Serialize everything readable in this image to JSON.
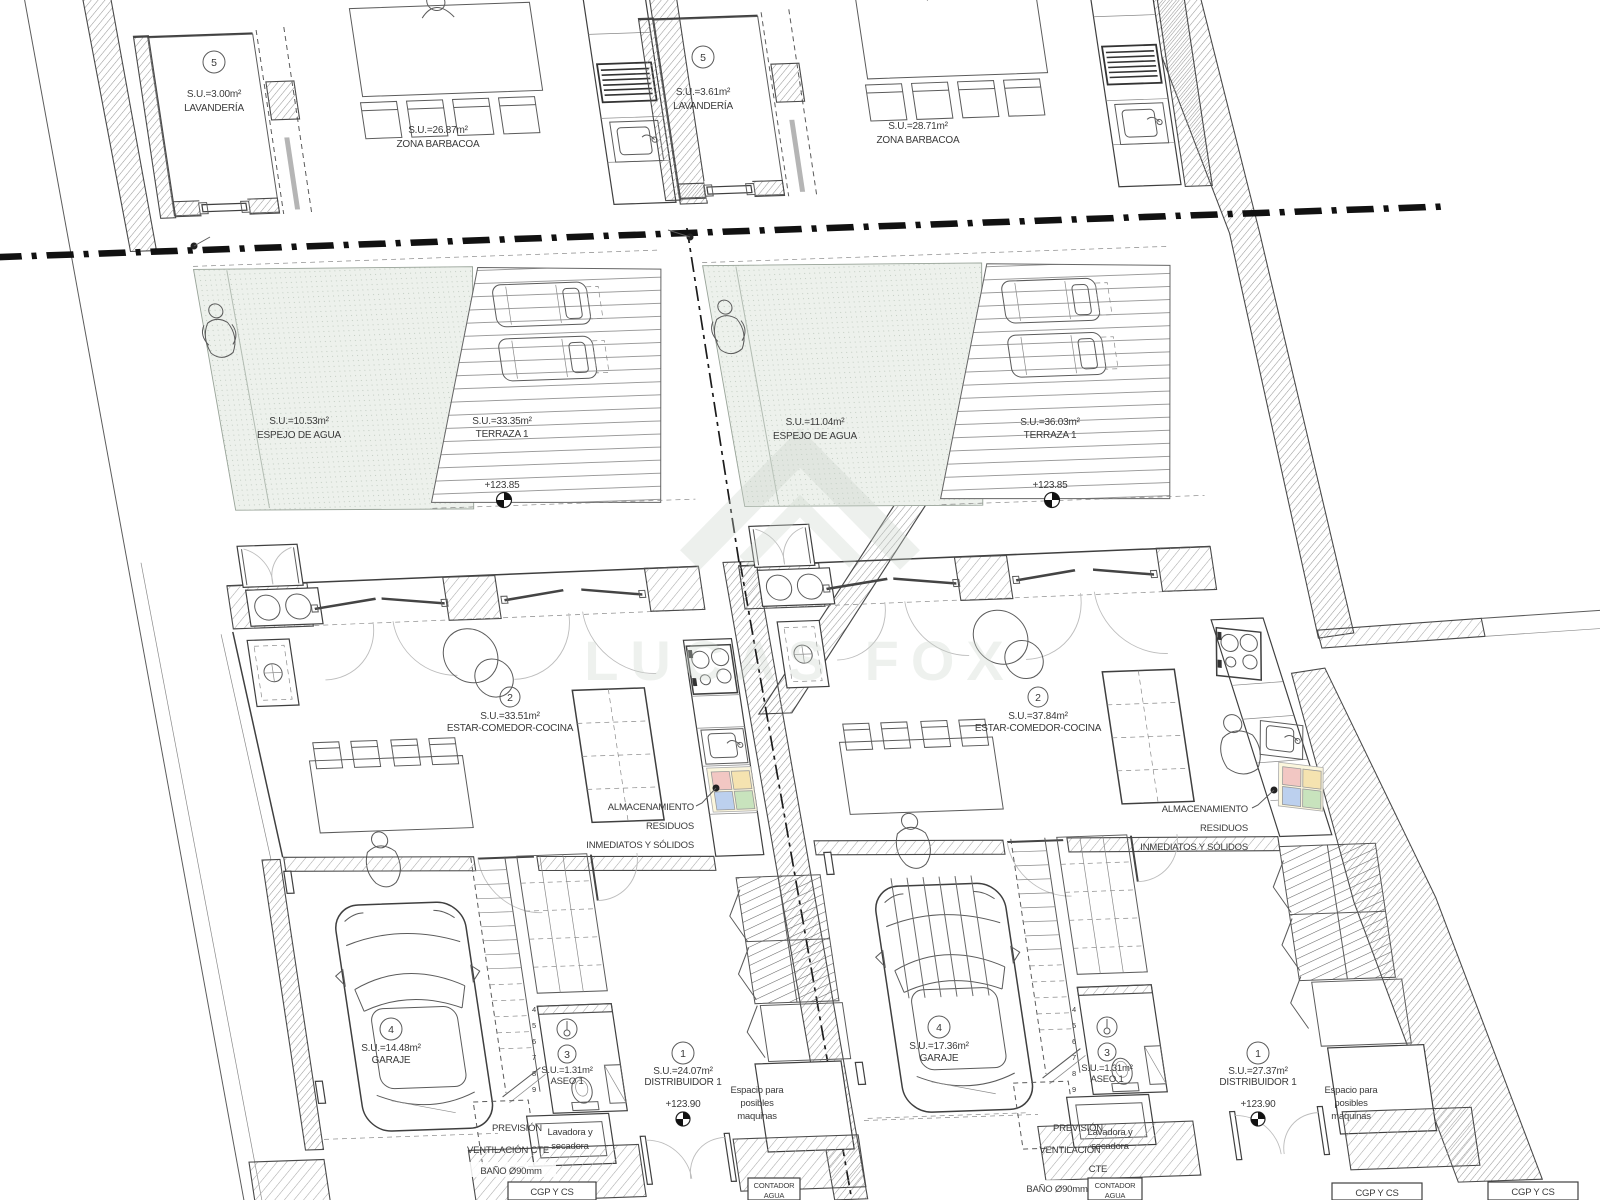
{
  "watermark": "LUCAS FOX",
  "neighbor": {
    "cgp": "CGP Y CS"
  },
  "units": [
    {
      "id": "left",
      "lavanderia": {
        "num": "5",
        "su": "S.U.=3.00m²",
        "name": "LAVANDERÍA"
      },
      "barbacoa": {
        "su": "S.U.=26.87m²",
        "name": "ZONA BARBACOA"
      },
      "espejo": {
        "su": "S.U.=10.53m²",
        "name": "ESPEJO DE AGUA"
      },
      "terraza": {
        "su": "S.U.=33.35m²",
        "name": "TERRAZA 1",
        "elevation": "+123.85"
      },
      "estar": {
        "num": "2",
        "su": "S.U.=33.51m²",
        "name": "ESTAR-COMEDOR-COCINA"
      },
      "almacenamiento": {
        "line1": "ALMACENAMIENTO",
        "line2": "RESIDUOS",
        "line3": "INMEDIATOS Y SÓLIDOS"
      },
      "garaje": {
        "num": "4",
        "su": "S.U.=14.48m²",
        "name": "GARAJE"
      },
      "aseo": {
        "num": "3",
        "su": "S.U.=1.31m²",
        "name": "ASEO 1"
      },
      "distribuidor": {
        "num": "1",
        "su": "S.U.=24.07m²",
        "name": "DISTRIBUIDOR 1",
        "elevation": "+123.90"
      },
      "prevision": {
        "line1": "PREVISIÓN",
        "line2": "VENTILACIÓN CTE",
        "line3": ""
      },
      "lavadora": {
        "line1": "Lavadora y",
        "line2": "secadora"
      },
      "bano": "BAÑO Ø90mm",
      "espacio": {
        "line1": "Espacio para",
        "line2": "posibles",
        "line3": "maquinas"
      },
      "cgp": "CGP Y CS",
      "contador": {
        "line1": "CONTADOR",
        "line2": "AGUA"
      },
      "stairs": [
        "4",
        "5",
        "6",
        "7",
        "8",
        "9"
      ]
    },
    {
      "id": "right",
      "lavanderia": {
        "num": "5",
        "su": "S.U.=3.61m²",
        "name": "LAVANDERÍA"
      },
      "barbacoa": {
        "su": "S.U.=28.71m²",
        "name": "ZONA BARBACOA"
      },
      "espejo": {
        "su": "S.U.=11.04m²",
        "name": "ESPEJO DE AGUA"
      },
      "terraza": {
        "su": "S.U.=36.03m²",
        "name": "TERRAZA 1",
        "elevation": "+123.85"
      },
      "estar": {
        "num": "2",
        "su": "S.U.=37.84m²",
        "name": "ESTAR-COMEDOR-COCINA"
      },
      "almacenamiento": {
        "line1": "ALMACENAMIENTO",
        "line2": "RESIDUOS",
        "line3": "INMEDIATOS Y SÓLIDOS"
      },
      "garaje": {
        "num": "4",
        "su": "S.U.=17.36m²",
        "name": "GARAJE"
      },
      "aseo": {
        "num": "3",
        "su": "S.U.=1.31m²",
        "name": "ASEO 1"
      },
      "distribuidor": {
        "num": "1",
        "su": "S.U.=27.37m²",
        "name": "DISTRIBUIDOR 1",
        "elevation": "+123.90"
      },
      "prevision": {
        "line1": "PREVISIÓN",
        "line2": "VENTILACIÓN",
        "line3": "CTE"
      },
      "lavadora": {
        "line1": "Lavadora y",
        "line2": "secadora"
      },
      "bano": "BAÑO Ø90mm",
      "espacio": {
        "line1": "Espacio para",
        "line2": "posibles",
        "line3": "maquinas"
      },
      "cgp": "CGP Y CS",
      "contador": {
        "line1": "CONTADOR",
        "line2": "AGUA"
      },
      "stairs": [
        "4",
        "5",
        "6",
        "7",
        "8",
        "9"
      ]
    }
  ]
}
